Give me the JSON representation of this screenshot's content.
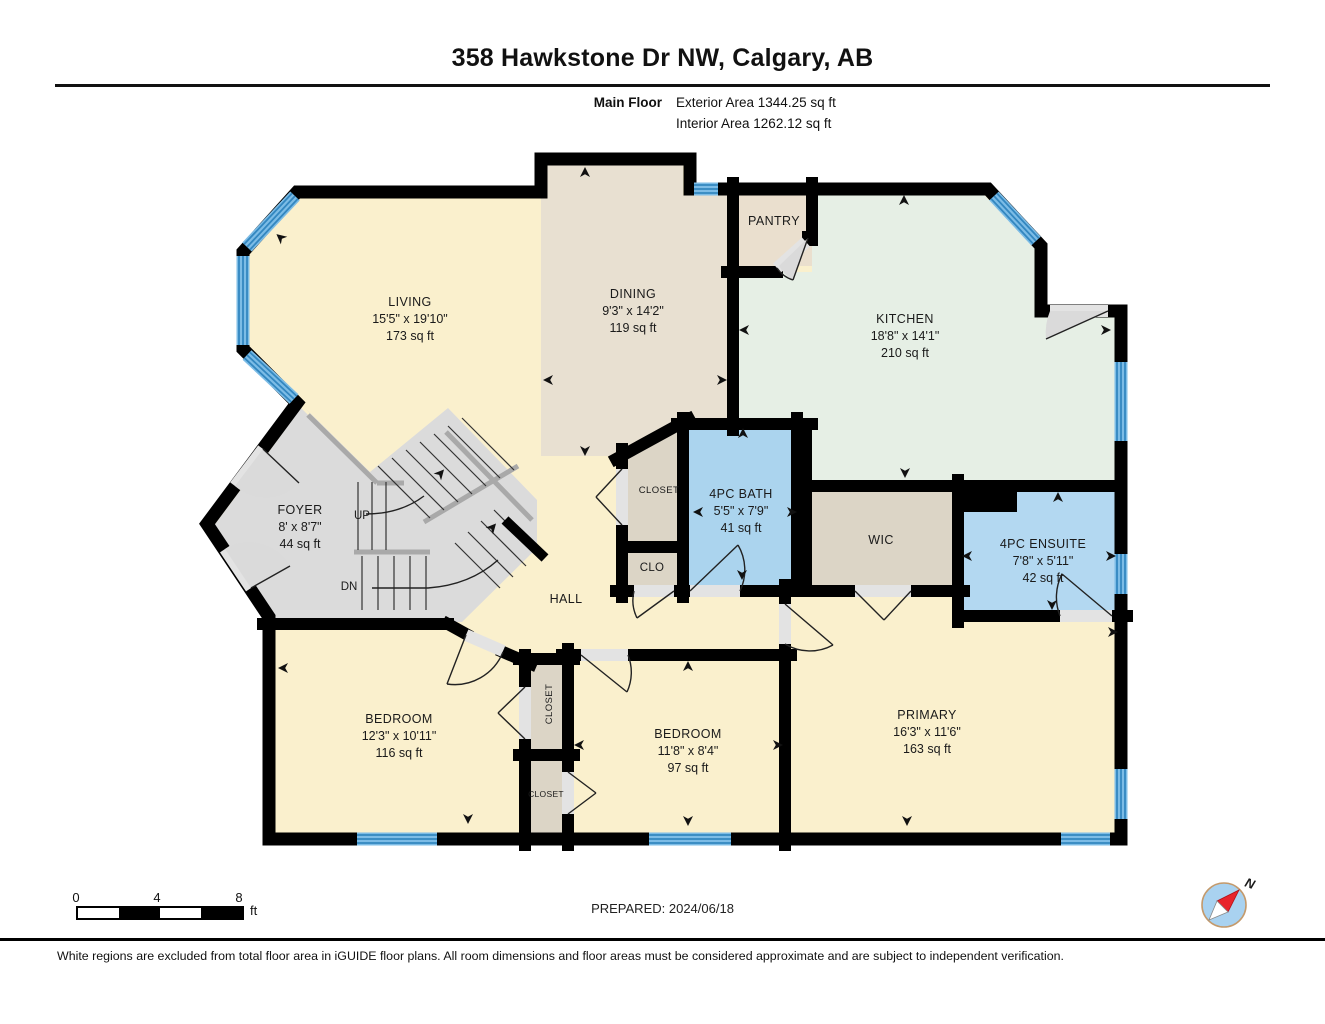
{
  "header": {
    "title": "358 Hawkstone Dr NW, Calgary, AB",
    "floor_label": "Main Floor",
    "exterior_area": "Exterior Area 1344.25 sq ft",
    "interior_area": "Interior Area 1262.12 sq ft"
  },
  "rooms": {
    "living": {
      "name": "LIVING",
      "dims": "15'5\" x 19'10\"",
      "area": "173 sq ft"
    },
    "dining": {
      "name": "DINING",
      "dims": "9'3\" x 14'2\"",
      "area": "119 sq ft"
    },
    "kitchen": {
      "name": "KITCHEN",
      "dims": "18'8\" x 14'1\"",
      "area": "210 sq ft"
    },
    "pantry": {
      "name": "PANTRY"
    },
    "foyer": {
      "name": "FOYER",
      "dims": "8' x 8'7\"",
      "area": "44 sq ft"
    },
    "hall": {
      "name": "HALL"
    },
    "bath": {
      "name": "4PC BATH",
      "dims": "5'5\" x 7'9\"",
      "area": "41 sq ft"
    },
    "ensuite": {
      "name": "4PC ENSUITE",
      "dims": "7'8\" x 5'11\"",
      "area": "42 sq ft"
    },
    "wic": {
      "name": "WIC"
    },
    "closet_hall": {
      "name": "CLOSET"
    },
    "clo": {
      "name": "CLO"
    },
    "bedroom1": {
      "name": "BEDROOM",
      "dims": "12'3\" x 10'11\"",
      "area": "116 sq ft"
    },
    "bedroom2": {
      "name": "BEDROOM",
      "dims": "11'8\" x 8'4\"",
      "area": "97 sq ft"
    },
    "primary": {
      "name": "PRIMARY",
      "dims": "16'3\" x 11'6\"",
      "area": "163 sq ft"
    },
    "closet_bed1": {
      "name": "CLOSET"
    },
    "closet_bed2": {
      "name": "CLOSET"
    },
    "stairs": {
      "up": "UP",
      "down": "DN"
    }
  },
  "scale_bar": {
    "tick0": "0",
    "tick4": "4",
    "tick8": "8",
    "unit": "ft"
  },
  "compass": {
    "north_label": "N"
  },
  "footer": {
    "prepared": "PREPARED: 2024/06/18",
    "disclaimer": "White regions are excluded from total floor area in iGUIDE floor plans. All room dimensions and floor areas must be considered approximate and are subject to independent verification."
  },
  "palette": {
    "floor_cream": "#FAF0CD",
    "floor_tan": "#E8E0D1",
    "floor_mint": "#E6EFE5",
    "floor_blue": "#ABD4EE",
    "floor_gray": "#DBDBDB",
    "floor_closet": "#DCD5C6",
    "window_blue": "#7CBCE6",
    "window_stripe": "#3387C0",
    "wall_black": "#000000",
    "compass_red": "#E8242C",
    "compass_ring": "#C49A6C"
  }
}
